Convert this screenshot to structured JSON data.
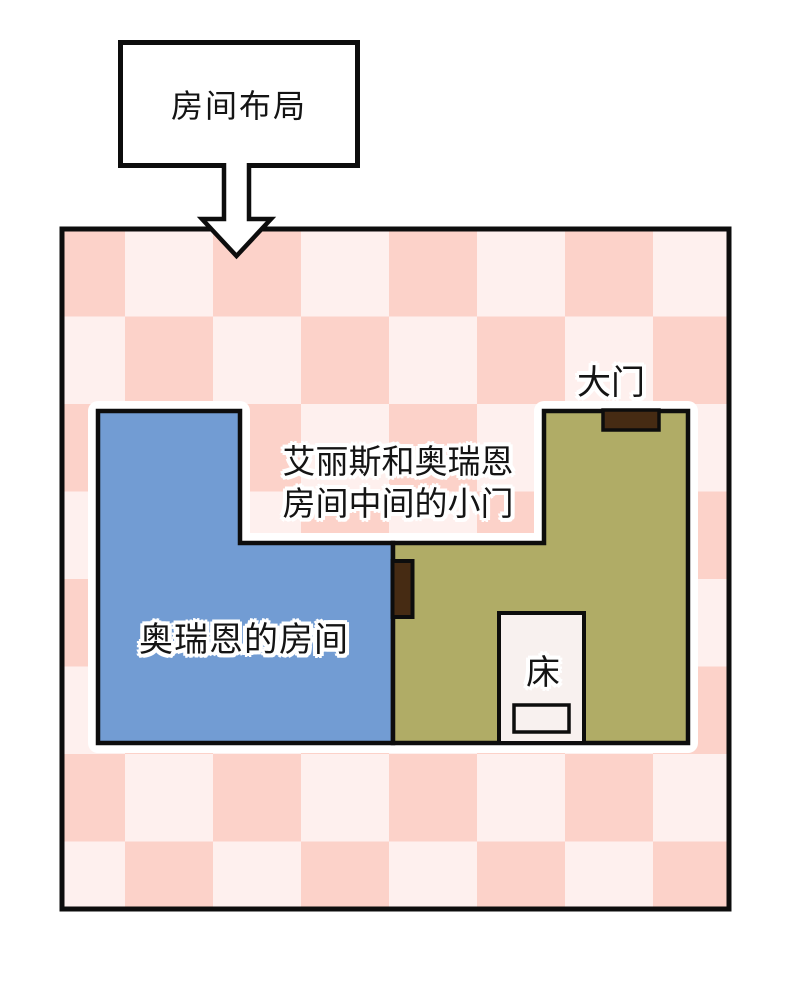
{
  "diagram": {
    "title": "房间布局",
    "labels": {
      "main_door": "大门",
      "middle_door_line1": "艾丽斯和奥瑞恩",
      "middle_door_line2": "房间中间的小门",
      "orien_room": "奥瑞恩的房间",
      "bed": "床"
    },
    "colors": {
      "checker_dark": "#FCD2C9",
      "checker_light": "#FEF0EE",
      "orien_room_fill": "#729CD3",
      "alice_room_fill": "#B0AC66",
      "door_fill": "#462B13",
      "bed_fill": "#F8F1EF",
      "outline": "#0d0d0d",
      "halo": "#FFFFFF",
      "arrow_fill": "#FFFFFF"
    }
  }
}
